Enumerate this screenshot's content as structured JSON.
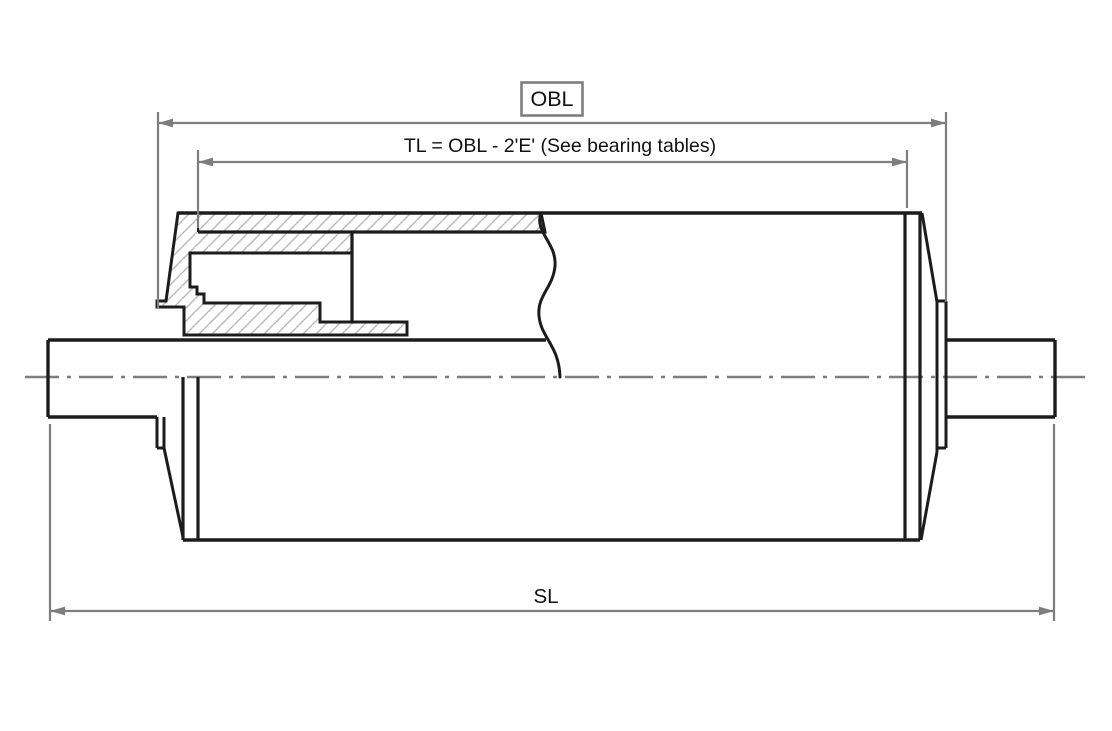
{
  "drawing": {
    "type": "conveyor-pulley-cross-section",
    "labels": {
      "obl": "OBL",
      "tl_formula": "TL = OBL - 2'E' (See bearing tables)",
      "sl": "SL"
    },
    "colors": {
      "outline": "#1c1c1c",
      "dimension": "#7e7e7e",
      "hatch": "#b8b8b8",
      "background": "#ffffff"
    }
  }
}
